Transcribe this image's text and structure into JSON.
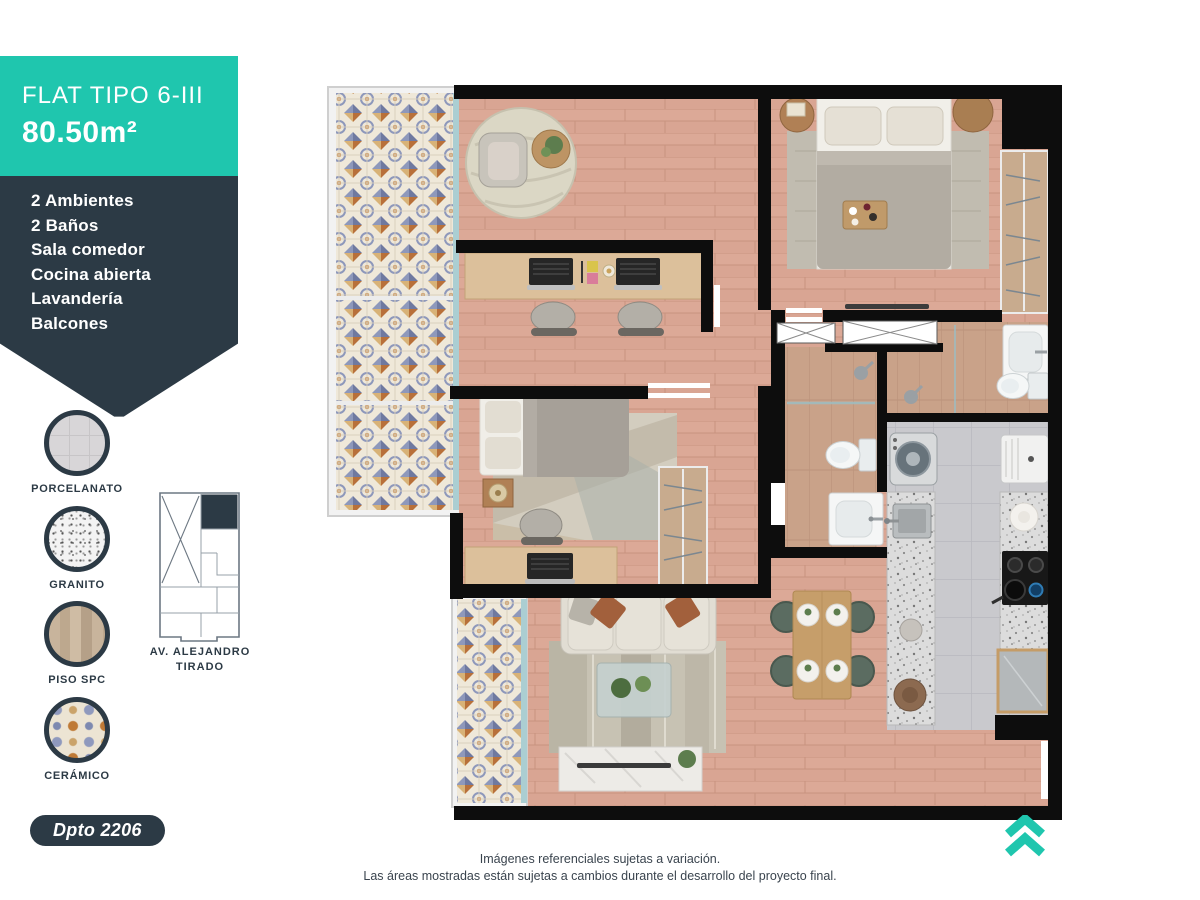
{
  "sidebar": {
    "header": {
      "type_label": "FLAT TIPO 6-III",
      "area_label": "80.50m²"
    },
    "features": [
      "2 Ambientes",
      "2 Baños",
      "Sala comedor",
      "Cocina abierta",
      "Lavandería",
      "Balcones"
    ],
    "materials": [
      {
        "label": "PORCELANATO"
      },
      {
        "label": "GRANITO"
      },
      {
        "label": "PISO SPC"
      },
      {
        "label": "CERÁMICO"
      }
    ],
    "keyplan": {
      "street_line1": "AV. ALEJANDRO",
      "street_line2": "TIRADO"
    },
    "unit_badge": "Dpto 2206"
  },
  "footer": {
    "disclaimer": [
      "Imágenes referenciales sujetas a variación.",
      "Las áreas mostradas están sujetas a cambios durante el desarrollo del proyecto final."
    ]
  },
  "colors": {
    "accent": "#1FC6AE",
    "dark_slate": "#2C3A45",
    "wood_floor": "#D9A593"
  }
}
